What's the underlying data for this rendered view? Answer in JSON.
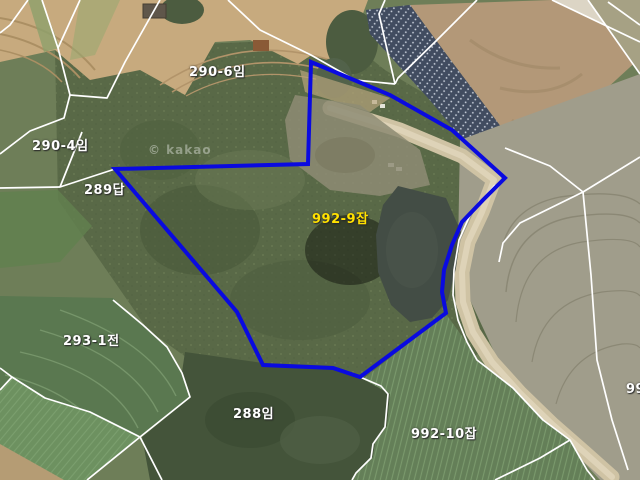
{
  "map": {
    "watermark": "© kakao",
    "boundaries": {
      "stroke": "#ffffff",
      "lines": [
        [
          [
            28,
            0
          ],
          [
            10,
            25
          ],
          [
            0,
            33
          ]
        ],
        [
          [
            42,
            0
          ],
          [
            58,
            48
          ],
          [
            70,
            95
          ],
          [
            64,
            118
          ],
          [
            30,
            131
          ],
          [
            0,
            154
          ]
        ],
        [
          [
            80,
            0
          ],
          [
            58,
            48
          ]
        ],
        [
          [
            160,
            0
          ],
          [
            125,
            62
          ],
          [
            107,
            98
          ],
          [
            70,
            95
          ]
        ],
        [
          [
            0,
            188
          ],
          [
            60,
            187
          ],
          [
            115,
            169
          ]
        ],
        [
          [
            82,
            132
          ],
          [
            60,
            187
          ]
        ],
        [
          [
            228,
            0
          ],
          [
            260,
            30
          ],
          [
            311,
            55
          ],
          [
            355,
            80
          ],
          [
            395,
            84
          ]
        ],
        [
          [
            385,
            0
          ],
          [
            379,
            14
          ],
          [
            386,
            45
          ],
          [
            395,
            84
          ]
        ],
        [
          [
            477,
            0
          ],
          [
            437,
            40
          ],
          [
            398,
            78
          ],
          [
            395,
            84
          ]
        ],
        [
          [
            552,
            0
          ],
          [
            640,
            42
          ]
        ],
        [
          [
            588,
            0
          ],
          [
            640,
            74
          ]
        ],
        [
          [
            608,
            2
          ],
          [
            640,
            25
          ]
        ],
        [
          [
            505,
            148
          ],
          [
            550,
            166
          ],
          [
            583,
            192
          ]
        ],
        [
          [
            583,
            192
          ],
          [
            640,
            157
          ]
        ],
        [
          [
            583,
            192
          ],
          [
            520,
            223
          ],
          [
            503,
            243
          ],
          [
            499,
            262
          ]
        ],
        [
          [
            583,
            192
          ],
          [
            591,
            275
          ],
          [
            597,
            360
          ],
          [
            612,
            420
          ],
          [
            628,
            470
          ]
        ],
        [
          [
            495,
            185
          ],
          [
            470,
            215
          ],
          [
            459,
            240
          ],
          [
            454,
            270
          ],
          [
            453,
            295
          ],
          [
            458,
            320
          ],
          [
            467,
            342
          ],
          [
            477,
            360
          ],
          [
            513,
            388
          ],
          [
            543,
            420
          ],
          [
            570,
            440
          ],
          [
            587,
            470
          ],
          [
            595,
            480
          ]
        ],
        [
          [
            570,
            440
          ],
          [
            540,
            458
          ],
          [
            495,
            480
          ]
        ],
        [
          [
            360,
            377
          ],
          [
            381,
            386
          ],
          [
            388,
            394
          ],
          [
            385,
            427
          ],
          [
            373,
            444
          ],
          [
            371,
            458
          ],
          [
            356,
            473
          ],
          [
            352,
            480
          ]
        ],
        [
          [
            113,
            300
          ],
          [
            143,
            325
          ],
          [
            167,
            347
          ],
          [
            182,
            373
          ],
          [
            190,
            397
          ],
          [
            140,
            437
          ]
        ],
        [
          [
            140,
            437
          ],
          [
            162,
            480
          ]
        ],
        [
          [
            140,
            437
          ],
          [
            87,
            480
          ]
        ],
        [
          [
            0,
            368
          ],
          [
            12,
            377
          ],
          [
            0,
            390
          ]
        ],
        [
          [
            12,
            377
          ],
          [
            45,
            398
          ],
          [
            90,
            412
          ],
          [
            140,
            437
          ]
        ]
      ]
    },
    "highlight_parcel": {
      "label": "992-9잡",
      "stroke": "#0a0ae0",
      "points": [
        [
          311,
          62
        ],
        [
          390,
          95
        ],
        [
          452,
          130
        ],
        [
          505,
          178
        ],
        [
          483,
          200
        ],
        [
          462,
          222
        ],
        [
          452,
          245
        ],
        [
          444,
          270
        ],
        [
          442,
          292
        ],
        [
          446,
          313
        ],
        [
          360,
          377
        ],
        [
          333,
          368
        ],
        [
          263,
          365
        ],
        [
          237,
          312
        ],
        [
          115,
          169
        ],
        [
          308,
          164
        ]
      ]
    },
    "labels": [
      {
        "name": "290-6",
        "text": "290-6임",
        "color": "#ffffff",
        "x": 189,
        "y": 61
      },
      {
        "name": "290-4",
        "text": "290-4임",
        "color": "#ffffff",
        "x": 32,
        "y": 135
      },
      {
        "name": "289",
        "text": "289답",
        "color": "#ffffff",
        "x": 84,
        "y": 179
      },
      {
        "name": "992-9",
        "text": "992-9잡",
        "color": "#ffe100",
        "x": 312,
        "y": 208
      },
      {
        "name": "293-1",
        "text": "293-1전",
        "color": "#ffffff",
        "x": 63,
        "y": 330
      },
      {
        "name": "288",
        "text": "288임",
        "color": "#ffffff",
        "x": 233,
        "y": 403
      },
      {
        "name": "992-10",
        "text": "992-10잡",
        "color": "#ffffff",
        "x": 411,
        "y": 423
      },
      {
        "name": "partial-right",
        "text": "99",
        "color": "#ffffff",
        "x": 626,
        "y": 382
      }
    ]
  }
}
